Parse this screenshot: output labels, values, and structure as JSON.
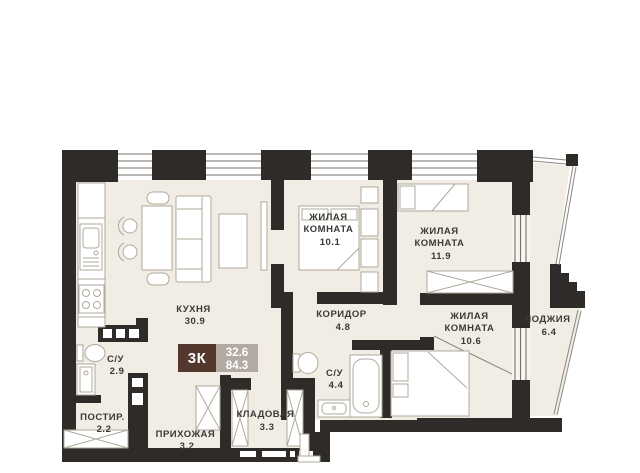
{
  "plan": {
    "badge": {
      "rooms_label": "3К",
      "area_living": "32.6",
      "area_total": "84.3"
    },
    "rooms": [
      {
        "id": "kitchen",
        "name": "КУХНЯ",
        "area": "30.9"
      },
      {
        "id": "bedroom1",
        "name": "ЖИЛАЯ",
        "name2": "КОМНАТА",
        "area": "10.1"
      },
      {
        "id": "bedroom2",
        "name": "ЖИЛАЯ",
        "name2": "КОМНАТА",
        "area": "11.9"
      },
      {
        "id": "bedroom3",
        "name": "ЖИЛАЯ",
        "name2": "КОМНАТА",
        "area": "10.6"
      },
      {
        "id": "corridor",
        "name": "КОРИДОР",
        "area": "4.8"
      },
      {
        "id": "loggia",
        "name": "ЛОДЖИЯ",
        "area": "6.4"
      },
      {
        "id": "bathroom1",
        "name": "С/У",
        "area": "2.9"
      },
      {
        "id": "bathroom2",
        "name": "С/У",
        "area": "4.4"
      },
      {
        "id": "laundry",
        "name": "ПОСТИР.",
        "area": "2.2"
      },
      {
        "id": "hallway",
        "name": "ПРИХОЖАЯ",
        "area": "3.2"
      },
      {
        "id": "storage",
        "name": "КЛАДОВАЯ",
        "area": "3.3"
      }
    ],
    "colors": {
      "wall": "#2E2B28",
      "floor": "#F2EDE4",
      "badge_brown": "#54382D",
      "badge_gray": "#B2A9A2",
      "text": "#3B3936"
    }
  }
}
